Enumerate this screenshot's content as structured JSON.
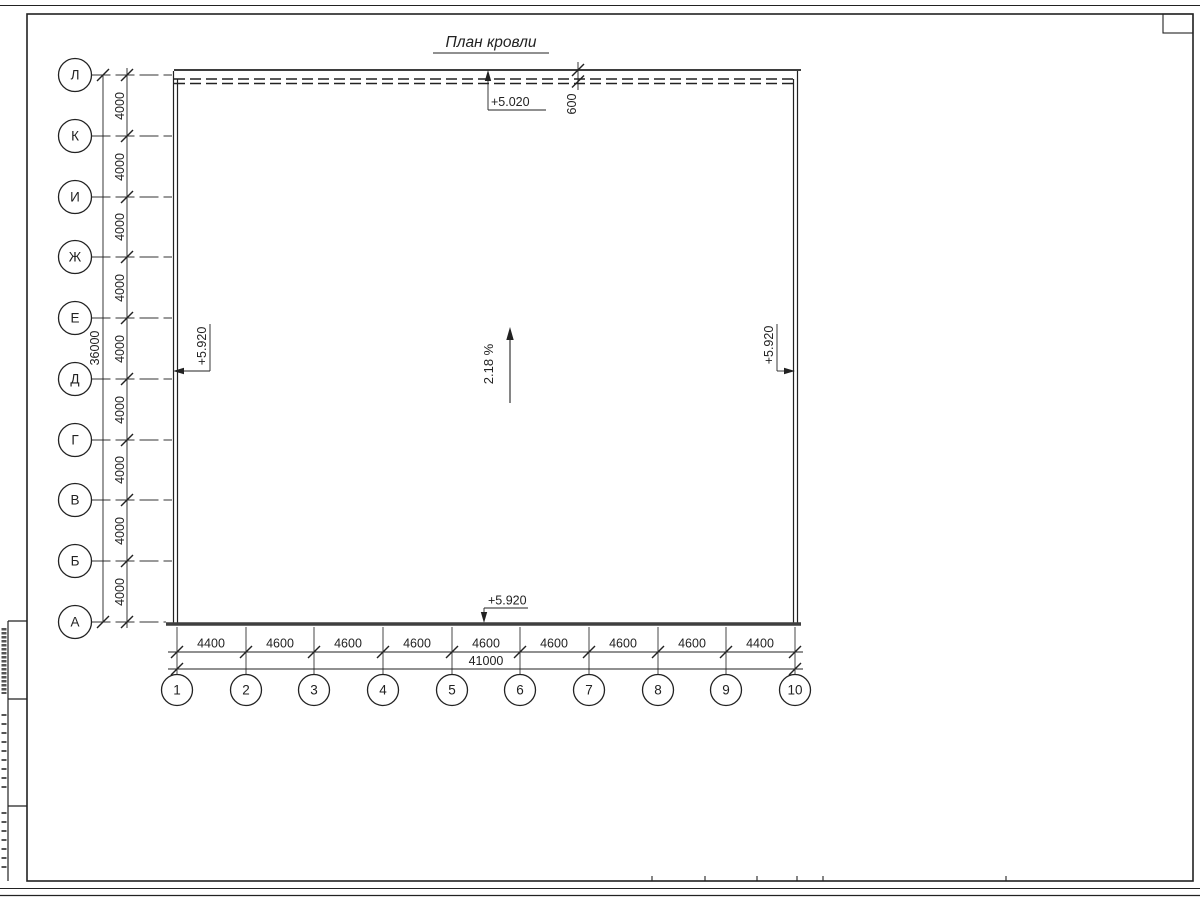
{
  "title": "План кровли",
  "row_axes": [
    "Л",
    "К",
    "И",
    "Ж",
    "Е",
    "Д",
    "Г",
    "В",
    "Б",
    "А"
  ],
  "col_axes": [
    "1",
    "2",
    "3",
    "4",
    "5",
    "6",
    "7",
    "8",
    "9",
    "10"
  ],
  "left_dim": {
    "total": "36000",
    "segments": [
      "4000",
      "4000",
      "4000",
      "4000",
      "4000",
      "4000",
      "4000",
      "4000",
      "4000"
    ]
  },
  "bottom_dim": {
    "total": "41000",
    "segments": [
      "4400",
      "4600",
      "4600",
      "4600",
      "4600",
      "4600",
      "4600",
      "4600",
      "4400"
    ]
  },
  "top_dim": {
    "overhang": "600"
  },
  "elevations": {
    "top": "+5.020",
    "left": "+5.920",
    "right": "+5.920",
    "bottom": "+5.920"
  },
  "slope_label": "2.18 %",
  "colors": {
    "line": "#222222",
    "thick_edge": "#3f3f3f"
  }
}
